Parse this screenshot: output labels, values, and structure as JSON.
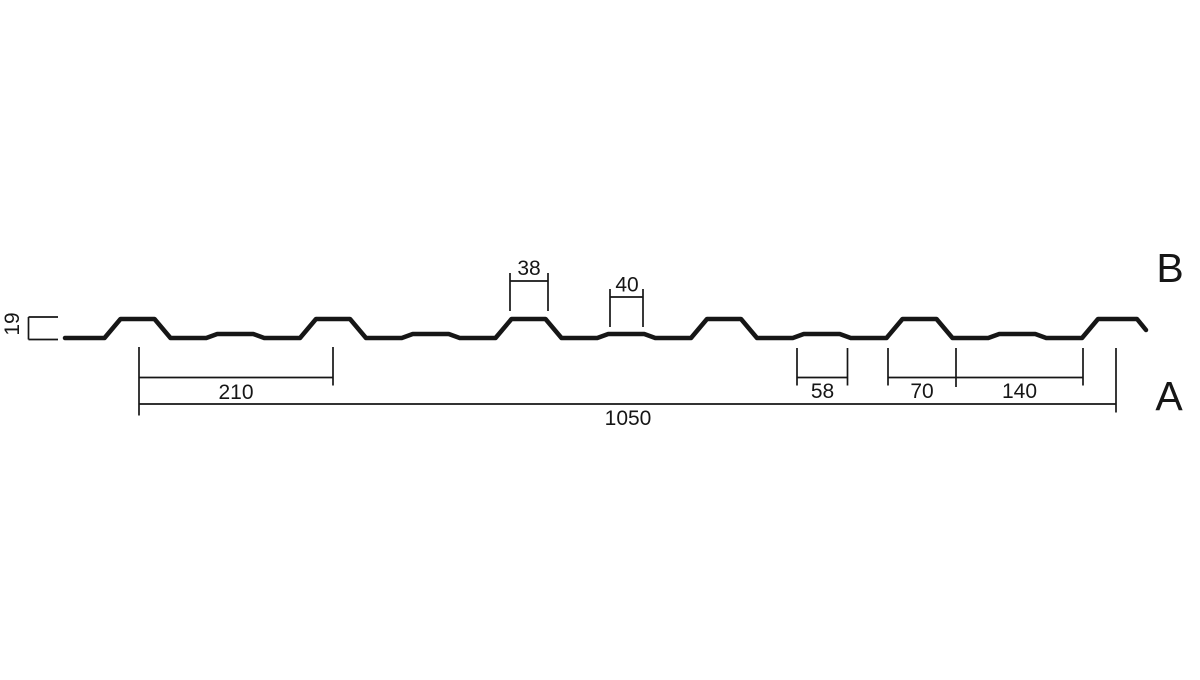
{
  "diagram": {
    "type": "profile-sheet-cross-section",
    "colors": {
      "line": "#161616",
      "background": "#ffffff"
    },
    "dimensions": {
      "profile_height": "19",
      "rib_top_width": "38",
      "groove_top_width": "40",
      "rib_pitch": "210",
      "groove_base_width": "58",
      "rib_base_width": "70",
      "valley_width": "140",
      "overall_width": "1050"
    },
    "side_labels": {
      "top_side": "B",
      "bottom_side": "A"
    }
  }
}
